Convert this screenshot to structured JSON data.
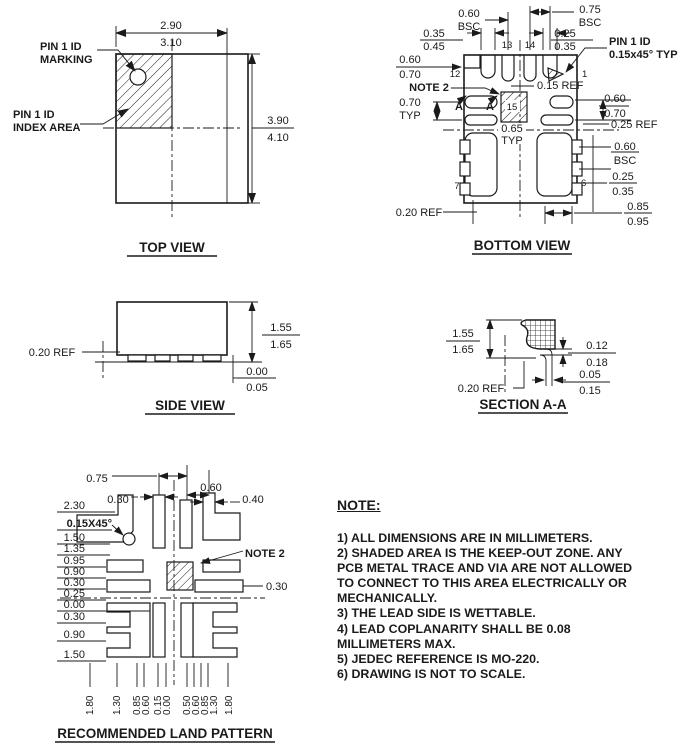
{
  "top_view": {
    "title": "TOP VIEW",
    "width_dim": [
      "2.90",
      "3.10"
    ],
    "height_dim": [
      "3.90",
      "4.10"
    ],
    "pin1_marking_label": [
      "PIN 1 ID",
      "MARKING"
    ],
    "pin1_index_label": [
      "PIN 1 ID",
      "INDEX AREA"
    ]
  },
  "bottom_view": {
    "title": "BOTTOM VIEW",
    "top_pitch_left": [
      "0.60",
      "BSC"
    ],
    "top_pitch_right": [
      "0.75",
      "BSC"
    ],
    "top_dim_left": [
      "0.35",
      "0.45"
    ],
    "top_dim_right": [
      "0.25",
      "0.35"
    ],
    "pin1_id_label": [
      "PIN 1 ID",
      "0.15x45° TYP"
    ],
    "left_dim_top": [
      "0.60",
      "0.70"
    ],
    "note2_label": "NOTE 2",
    "left_dim_mid": [
      "0.70",
      "TYP"
    ],
    "section_marks": [
      "A",
      "A"
    ],
    "inner_ref": "0.15 REF",
    "center_pitch": [
      "0.65",
      "TYP"
    ],
    "right_dim_top": [
      "0.60",
      "0.70"
    ],
    "right_ref": "0.25 REF",
    "right_dim_mid": [
      "0.60",
      "BSC"
    ],
    "right_dim_low": [
      "0.25",
      "0.35"
    ],
    "right_dim_bottom": [
      "0.85",
      "0.95"
    ],
    "bottom_ref": "0.20 REF",
    "pins": {
      "p1": "1",
      "p6": "6",
      "p7": "7",
      "p12": "12",
      "p13": "13",
      "p14": "14",
      "p15": "15"
    }
  },
  "side_view": {
    "title": "SIDE VIEW",
    "height_dim": [
      "1.55",
      "1.65"
    ],
    "standoff_dim": [
      "0.00",
      "0.05"
    ],
    "left_ref": "0.20 REF"
  },
  "section_aa": {
    "title": "SECTION A-A",
    "height_dim": [
      "1.55",
      "1.65"
    ],
    "side_dim": [
      "0.12",
      "0.18"
    ],
    "foot_dim": [
      "0.05",
      "0.15"
    ],
    "ref": "0.20 REF"
  },
  "land_pattern": {
    "title": "RECOMMENDED LAND PATTERN",
    "top_dims": [
      "0.75",
      "0.30",
      "0.60",
      "0.40"
    ],
    "chamfer_label": "0.15X45°",
    "note2_label": "NOTE 2",
    "right_dim": "0.30",
    "left_dims": [
      "2.30",
      "1.50",
      "1.35",
      "0.95",
      "0.90",
      "0.30",
      "0.25",
      "0.00",
      "0.30",
      "0.90",
      "1.50"
    ],
    "bottom_dims": [
      "1.80",
      "1.30",
      "0.85",
      "0.60",
      "0.15",
      "0.00",
      "0.50",
      "0.60",
      "0.85",
      "1.30",
      "1.80"
    ]
  },
  "notes": {
    "heading": "NOTE:",
    "lines": [
      "1) ALL DIMENSIONS ARE IN MILLIMETERS.",
      "2) SHADED AREA IS THE KEEP-OUT ZONE. ANY",
      "PCB METAL TRACE AND VIA ARE NOT ALLOWED",
      "TO CONNECT TO THIS AREA ELECTRICALLY OR",
      "MECHANICALLY.",
      "3) THE LEAD SIDE IS WETTABLE.",
      "4) LEAD COPLANARITY SHALL BE 0.08",
      "MILLIMETERS MAX.",
      "5) JEDEC REFERENCE IS MO-220.",
      "6) DRAWING IS NOT TO SCALE."
    ]
  }
}
